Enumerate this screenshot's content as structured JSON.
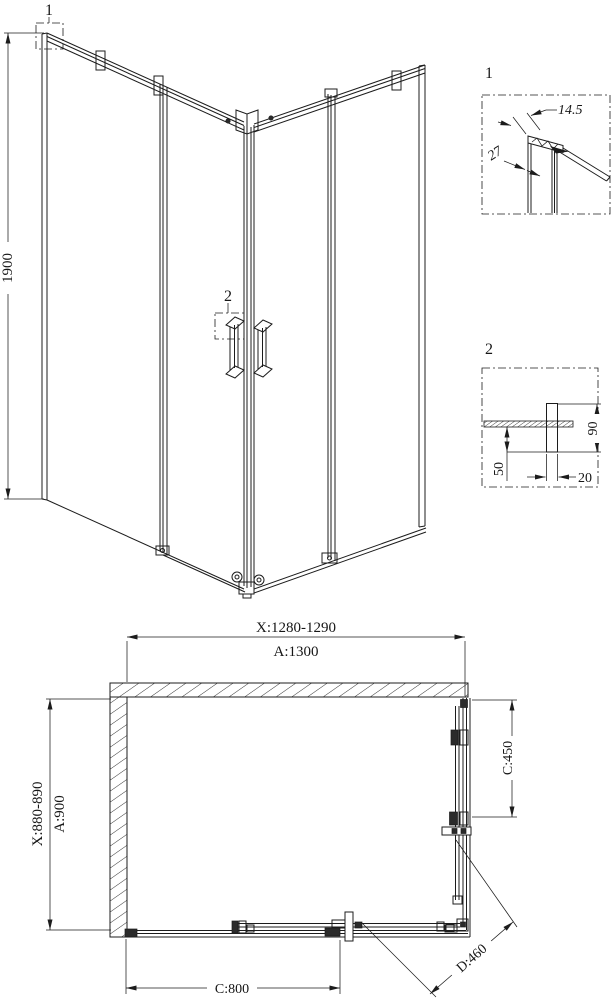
{
  "iso_view": {
    "callout_top_profile": "1",
    "callout_handle": "2",
    "height_dim": "1900"
  },
  "detail_1": {
    "label": "1",
    "profile_width_dim": "14.5",
    "profile_depth_dim": "27"
  },
  "detail_2": {
    "label": "2",
    "handle_length_dim": "90",
    "handle_inner_dim": "50",
    "handle_width_dim": "20"
  },
  "plan_view": {
    "top_adjust_dim": "X:1280-1290",
    "top_total_dim": "A:1300",
    "left_adjust_dim": "X:880-890",
    "left_total_dim": "A:900",
    "right_door_dim": "C:450",
    "bottom_door_dim": "C:800",
    "diagonal_entry_dim": "D:460"
  },
  "colors": {
    "line": "#1c1c1c",
    "background": "#ffffff"
  }
}
